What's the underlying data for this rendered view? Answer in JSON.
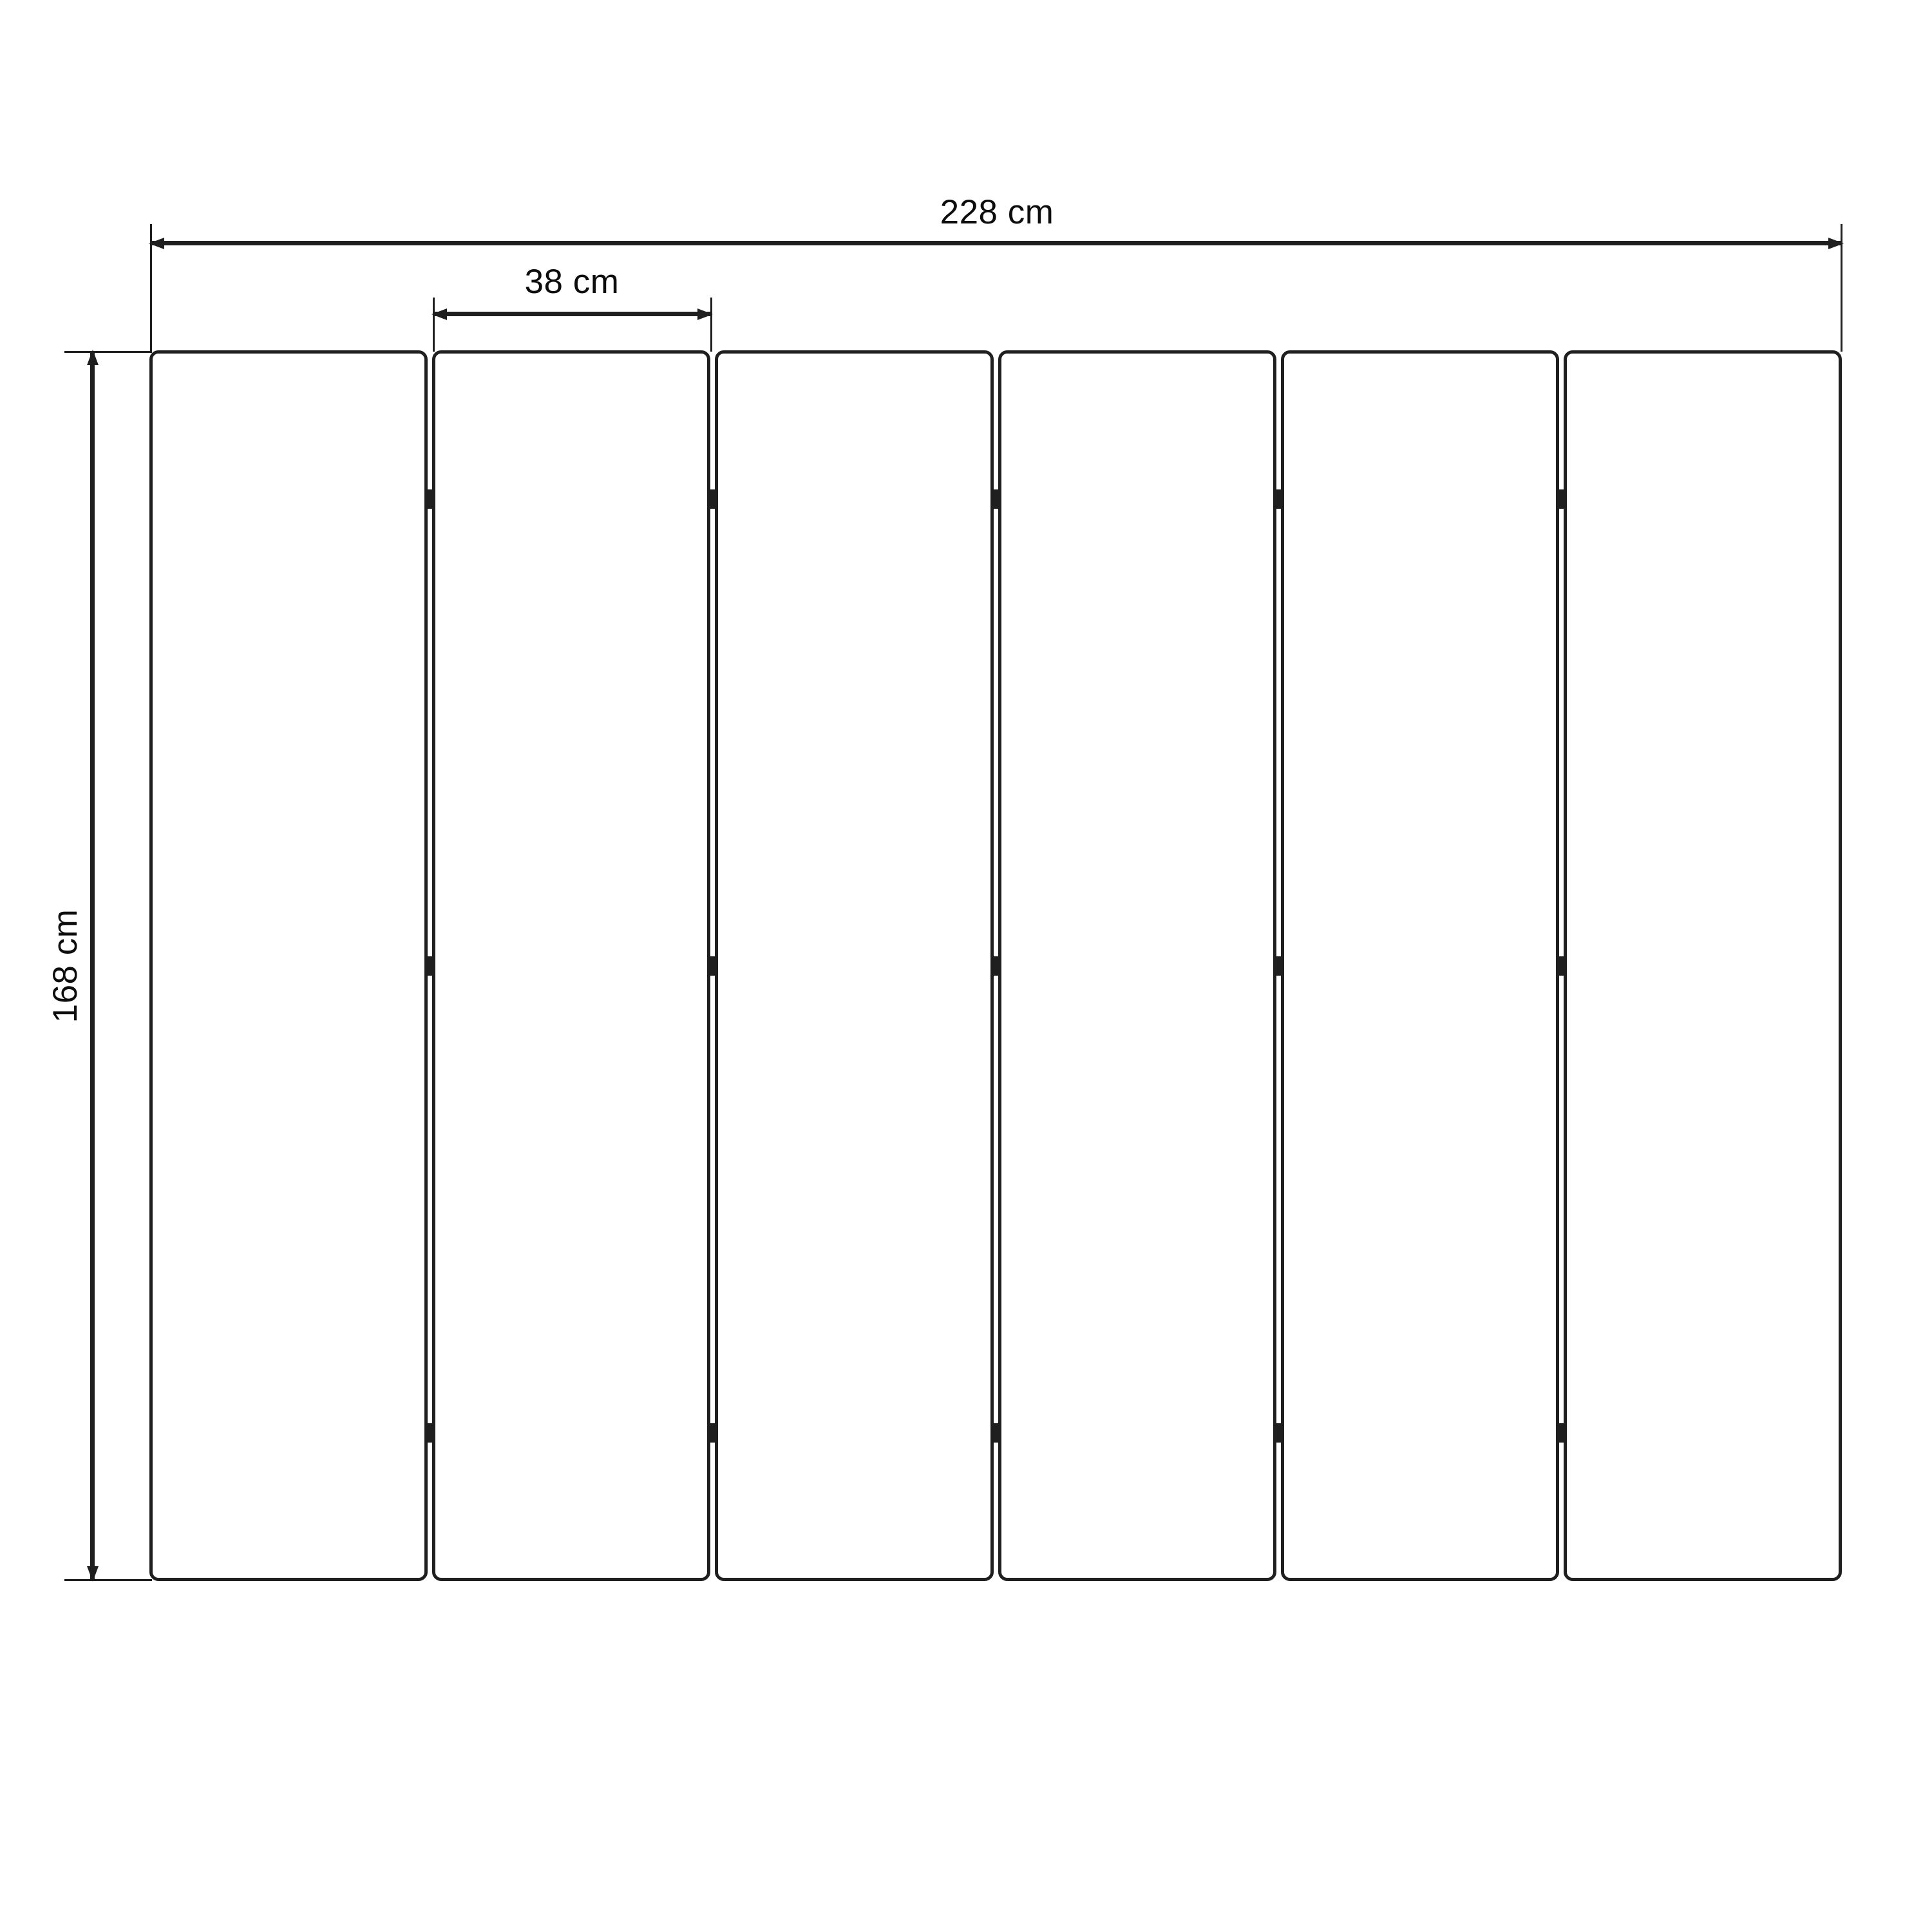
{
  "drawing": {
    "dimensions": {
      "total_width": {
        "label": "228 cm"
      },
      "panel_width": {
        "label": "38 cm"
      },
      "height": {
        "label": "168 cm"
      }
    },
    "panels": {
      "count": 6,
      "hinge_rows": 3,
      "hinge_junctions": 5
    },
    "colors": {
      "line": "#1f1f1f",
      "text": "#0d0d0d",
      "background": "#ffffff"
    }
  }
}
